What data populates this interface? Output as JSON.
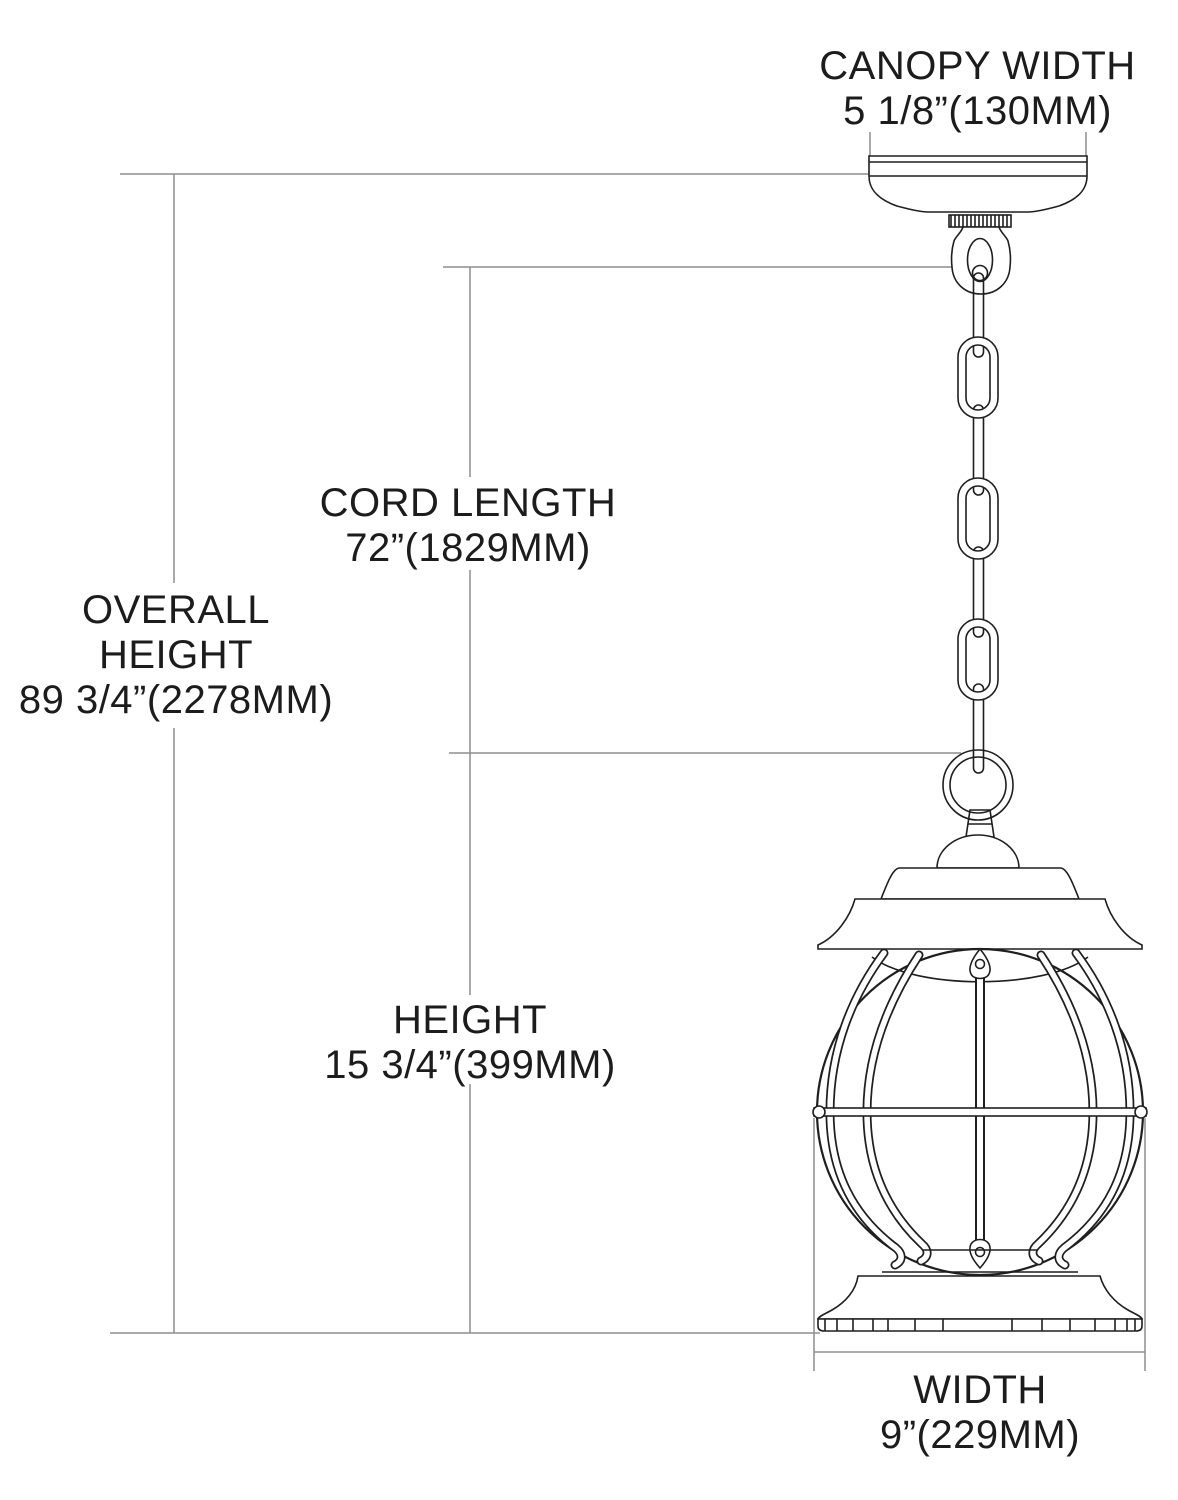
{
  "diagram_title": "Pendant lantern dimension diagram",
  "labels": {
    "canopy_width": {
      "name": "CANOPY WIDTH",
      "value": "5 1/8”(130MM)"
    },
    "cord_length": {
      "name": "CORD LENGTH",
      "value": "72”(1829MM)"
    },
    "overall_height": {
      "name_line1": "OVERALL",
      "name_line2": "HEIGHT",
      "value": "89 3/4”(2278MM)"
    },
    "height": {
      "name": "HEIGHT",
      "value": "15 3/4”(399MM)"
    },
    "width": {
      "name": "WIDTH",
      "value": "9”(229MM)"
    }
  },
  "colors": {
    "background": "#ffffff",
    "fixture_outline": "#1f1f1f",
    "dimension_line": "#8d8d8d",
    "text": "#1c1c1c"
  }
}
